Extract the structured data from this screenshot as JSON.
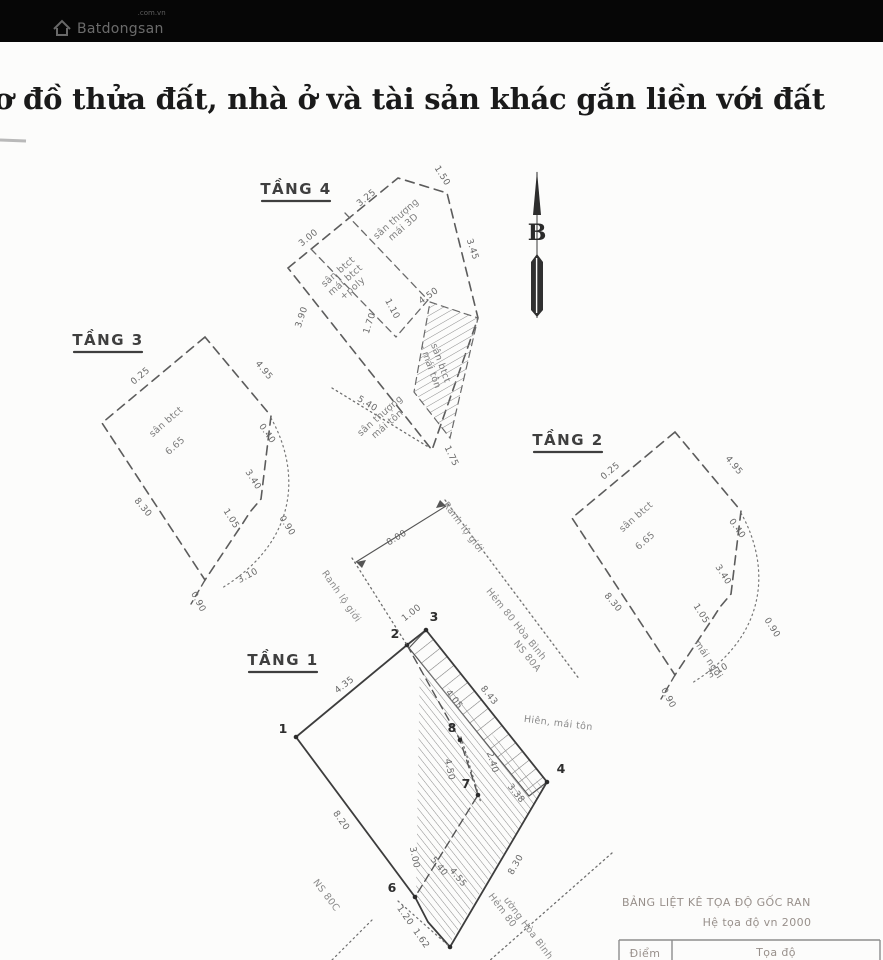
{
  "header": {
    "brand": "Batdongsan",
    "brand_suffix": ".com.vn",
    "title": "ơ đồ thửa đất, nhà ở và tài sản khác gắn liền với đất"
  },
  "compass": {
    "north_label": "B"
  },
  "floor4": {
    "label": "TẦNG 4",
    "room_top_1": "sân thượng",
    "room_top_2": "mái 3D",
    "room_left_1": "sân btct",
    "room_left_2": "mái btct",
    "room_left_3": "+poly",
    "room_right_1": "sân btct",
    "room_right_2": "- mái tôn",
    "room_bottom_1": "sân thượng",
    "room_bottom_2": "mái tôn",
    "dim_top_left": "3.00",
    "dim_top": "3.25",
    "dim_top_right": "1.50",
    "dim_right": "3.45",
    "dim_left": "3.90",
    "dim_inner_a": "1.70",
    "dim_inner_b": "1.10",
    "dim_inner_c": "4.50",
    "dim_bottom_left": "5.40",
    "dim_bottom": "1.75"
  },
  "floor3": {
    "label": "TẦNG 3",
    "room": "sân btct",
    "area": "6.65",
    "dim_top_left": "0.25",
    "dim_top_right": "4.95",
    "dim_right_a": "0.40",
    "dim_right_b": "3.40",
    "dim_right_c": "1.05",
    "dim_arc": "0.90",
    "dim_left": "8.30",
    "dim_bottom": "3.10",
    "dim_tail": "0.90"
  },
  "floor2": {
    "label": "TẦNG 2",
    "room": "sân btct",
    "area": "6.65",
    "roof": "mái ngói",
    "dim_top_left": "0.25",
    "dim_top_right": "4.95",
    "dim_right_a": "0.40",
    "dim_right_b": "3.40",
    "dim_right_c": "1.05",
    "dim_arc": "0.90",
    "dim_left": "8.30",
    "dim_bottom": "3.10",
    "dim_tail": "0.90"
  },
  "floor1": {
    "label": "TẦNG 1",
    "p1": "1",
    "p2": "2",
    "p3": "3",
    "p4": "4",
    "p6": "6",
    "p7": "7",
    "p8": "8",
    "dim_gap23": "1.00",
    "dim_edge12": "4.35",
    "dim_strip_inner": "4.05",
    "dim_strip_outer": "8.43",
    "dim_inner87": "4.50",
    "dim_dotted": "2.40",
    "dim_edge74": "3.38",
    "dim_low_a": "3.00",
    "dim_low_b": "5.40",
    "dim_low_c": "4.55",
    "dim_edge45": "8.30",
    "dim_edge16": "8.20",
    "dim_jog_a": "1.20",
    "dim_jog_b": "1.62",
    "label_ranh_a": "Ranh lộ giới",
    "label_ranh_b": "Ranh lộ giới",
    "dim_street": "8.00",
    "label_street": "Hẻm 80 Hòa Bình",
    "label_ns80a": "NS 80A",
    "label_ns80c": "NS 80C",
    "label_porch": "Hiên, mái tôn",
    "label_street2a": "Hẻm 80",
    "label_street2b": "ường Hòa Bình"
  },
  "table": {
    "title": "BẢNG LIỆT KÊ TỌA ĐỘ GỐC RAN",
    "subtitle": "Hệ tọa độ vn 2000",
    "col_point": "Điểm",
    "col_coord": "Tọa độ"
  }
}
